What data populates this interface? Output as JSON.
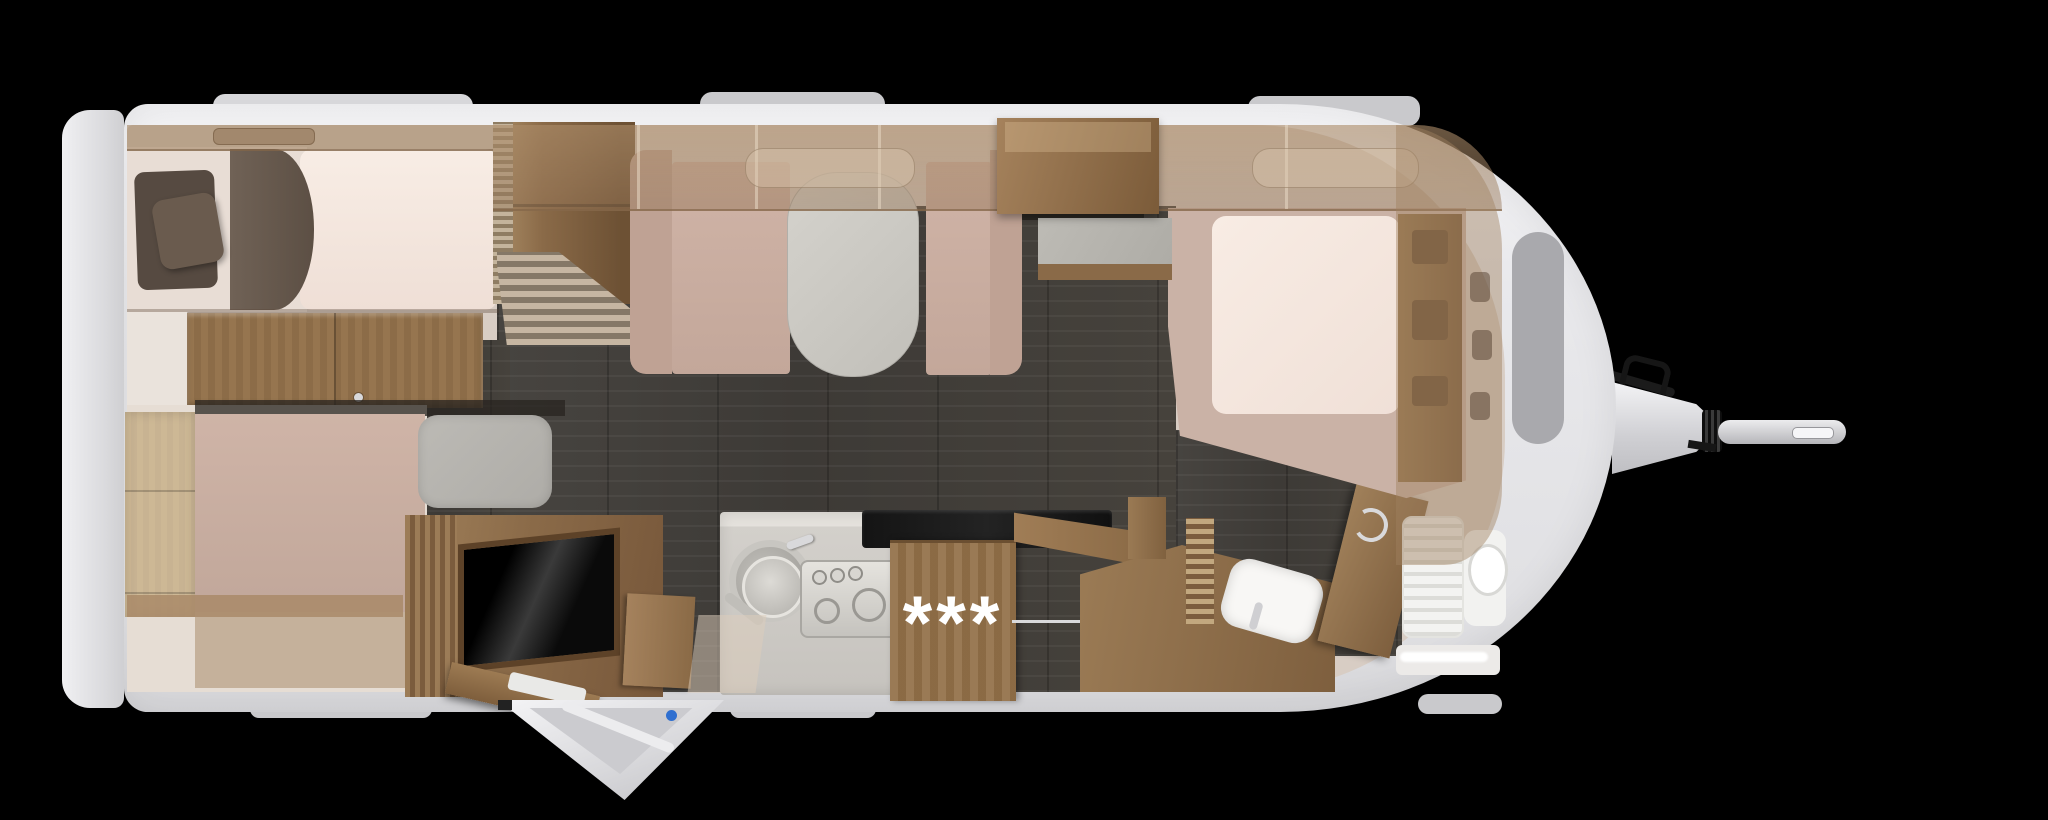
{
  "scene": {
    "type": "caravan-floorplan-top-view-cutaway-render",
    "background": "#000000",
    "visible_text": "***"
  },
  "kitchen": {
    "badge": "***"
  },
  "colors": {
    "shell_white": "#ececee",
    "bumper_gray": "#dadadd",
    "wood_brown": "#8a6a48",
    "wood_light": "#a5825d",
    "floor_dark": "#45413c",
    "mattress_cream": "#f5e9e1",
    "blanket_brown": "#6a5c51",
    "pillow_brown": "#584c43",
    "upholstery_rose": "#c9ada0",
    "table_gray": "#cbc9c3",
    "mat_gray": "#b5b3ae",
    "counter_gray": "#d6d3ce",
    "sanitary_white": "#f7f6f4",
    "cooktop_black": "#191919",
    "door_lock_blue": "#2f6fd0",
    "badge_text": "#ffffff"
  },
  "furniture_semantics": [
    "rear-single-bed",
    "pillows",
    "wardrobe",
    "bunk-ladder",
    "sideboard",
    "lounge-bed",
    "seat-mat",
    "tv-cabinet",
    "dinette-bench-left",
    "dinette-bench-right",
    "dinette-table",
    "overhead-lockers",
    "kitchen-counter",
    "sink-with-pan",
    "hob",
    "cooktop-glass",
    "kitchen-tall-cabinet",
    "vanity-washbasin",
    "bathroom-door",
    "shower-tray",
    "toilet",
    "front-double-bed",
    "entry-door-open",
    "exterior-hatch-open",
    "tow-hitch"
  ]
}
